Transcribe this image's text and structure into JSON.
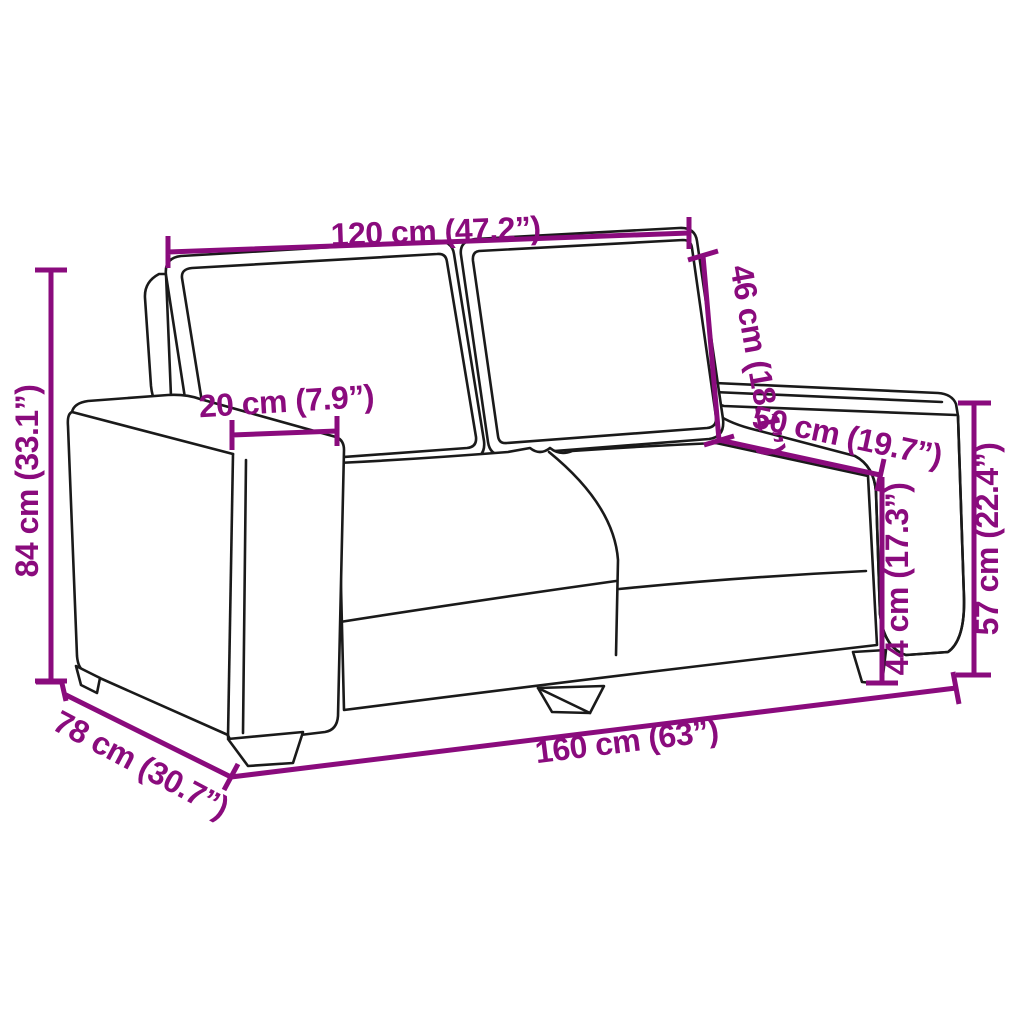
{
  "diagram": {
    "title": "sofa-dimension-diagram",
    "product": "2-seater sofa line drawing with measurements",
    "colors": {
      "dimension_color": "#8A0B7D",
      "outline_color": "#1A1A1A",
      "background": "#FFFFFF"
    },
    "dimensions": {
      "backrest_width": "120 cm (47.2”)",
      "backrest_height": "46 cm (18.1”)",
      "armrest_width": "20 cm (7.9”)",
      "seat_depth": "50 cm (19.7”)",
      "total_height": "84 cm (33.1”)",
      "seat_height": "44 cm (17.3”)",
      "armrest_height": "57 cm (22.4”)",
      "total_width": "160 cm (63”)",
      "total_depth": "78 cm (30.7”)"
    }
  }
}
